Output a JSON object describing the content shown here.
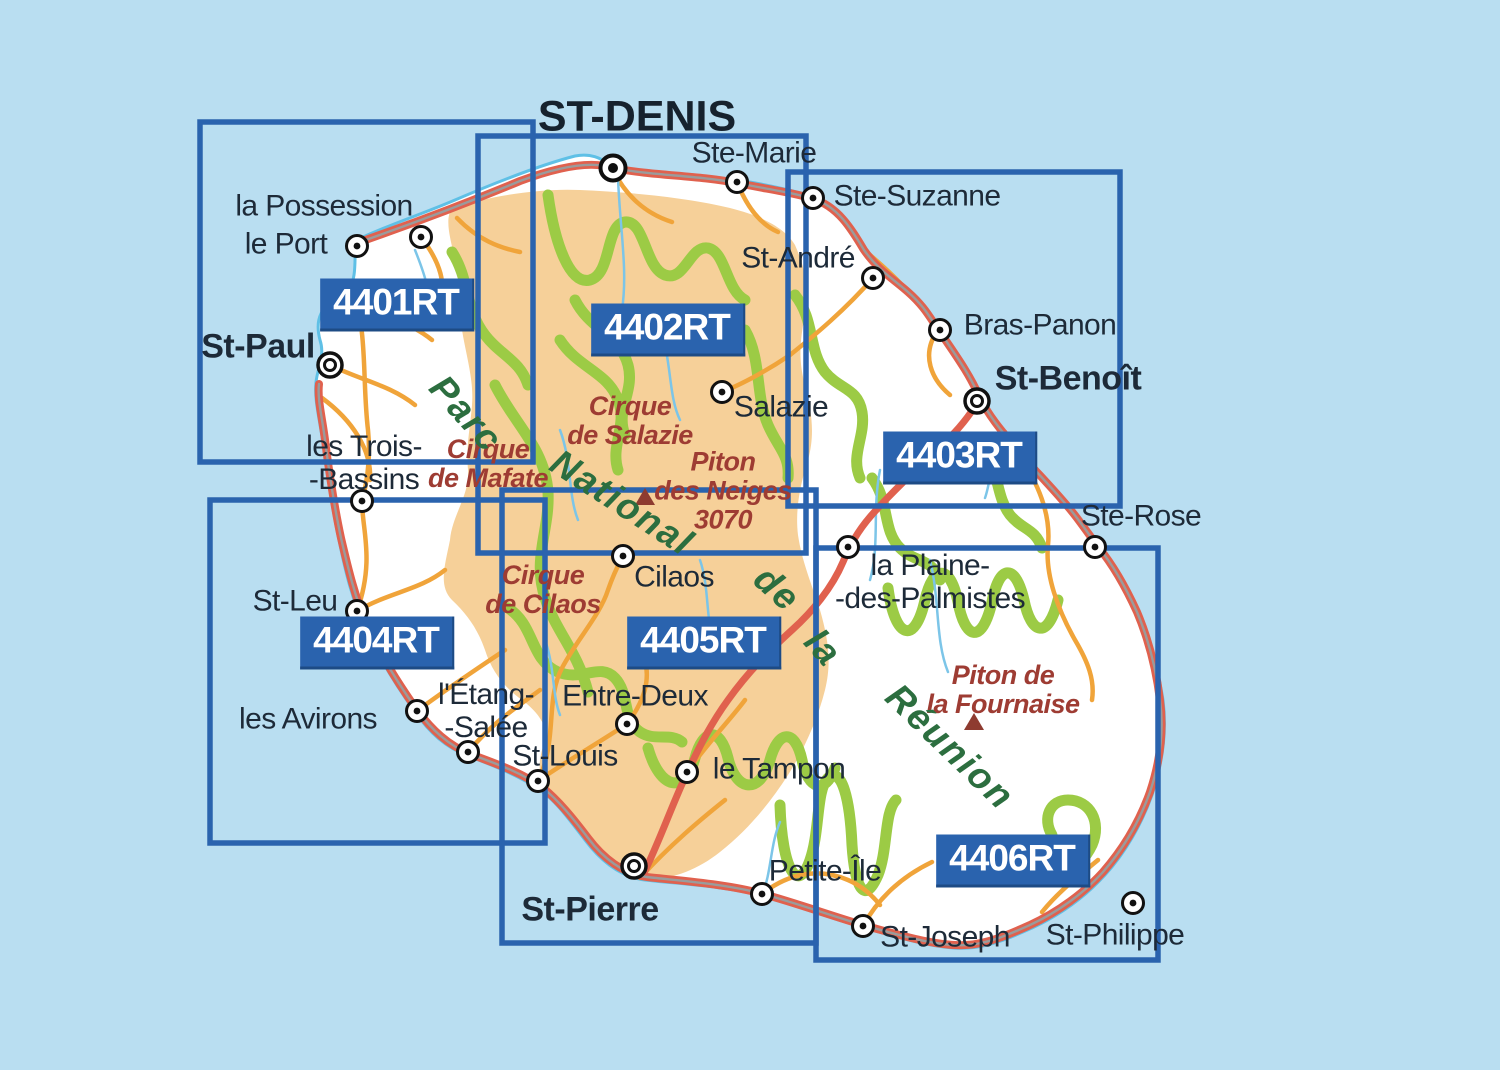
{
  "title": "Carte index des cartes IGN TOP25 R de la Réunion",
  "colors": {
    "sea": "#b9def1",
    "land": "#ffffff",
    "park_tan": "#f6d099",
    "coast": "#5fc0e6",
    "green_road": "#9ccb45",
    "orange_road": "#f0a43a",
    "red_road": "#e0614e",
    "road_core": "#9b9b9b",
    "river": "#7cc5e8",
    "sheet_blue": "#2a63ae",
    "town_text": "#1d2a38",
    "geo_red": "#9e3c33",
    "geo_green": "#2c6e3f",
    "peak": "#8e3b30"
  },
  "sheets": [
    {
      "code": "4401RT",
      "rect": {
        "x": 200,
        "y": 122,
        "w": 333,
        "h": 340
      },
      "label": {
        "cx": 397,
        "cy": 305
      }
    },
    {
      "code": "4402RT",
      "rect": {
        "x": 478,
        "y": 136,
        "w": 328,
        "h": 417
      },
      "label": {
        "cx": 668,
        "cy": 330
      }
    },
    {
      "code": "4403RT",
      "rect": {
        "x": 788,
        "y": 172,
        "w": 332,
        "h": 334
      },
      "label": {
        "cx": 960,
        "cy": 458
      }
    },
    {
      "code": "4404RT",
      "rect": {
        "x": 210,
        "y": 500,
        "w": 335,
        "h": 343
      },
      "label": {
        "cx": 377,
        "cy": 643
      }
    },
    {
      "code": "4405RT",
      "rect": {
        "x": 502,
        "y": 490,
        "w": 314,
        "h": 453
      },
      "label": {
        "cx": 704,
        "cy": 643
      }
    },
    {
      "code": "4406RT",
      "rect": {
        "x": 816,
        "y": 548,
        "w": 342,
        "h": 412
      },
      "label": {
        "cx": 1013,
        "cy": 861
      }
    }
  ],
  "towns": [
    {
      "name": "ST-DENIS",
      "dot": {
        "x": 613,
        "y": 168,
        "type": "capital"
      },
      "label": {
        "x": 637,
        "y": 117,
        "style": "caps"
      }
    },
    {
      "name": "Ste-Marie",
      "dot": {
        "x": 737,
        "y": 182,
        "type": "town"
      },
      "label": {
        "x": 754,
        "y": 153,
        "style": ""
      }
    },
    {
      "name": "Ste-Suzanne",
      "dot": {
        "x": 813,
        "y": 198,
        "type": "town"
      },
      "label": {
        "x": 917,
        "y": 196,
        "style": ""
      }
    },
    {
      "name": "la Possession",
      "dot": {
        "x": 421,
        "y": 237,
        "type": "town"
      },
      "label": {
        "x": 324,
        "y": 206,
        "style": ""
      }
    },
    {
      "name": "le Port",
      "dot": {
        "x": 357,
        "y": 246,
        "type": "town"
      },
      "label": {
        "x": 286,
        "y": 244,
        "style": ""
      }
    },
    {
      "name": "St-André",
      "dot": {
        "x": 873,
        "y": 278,
        "type": "town"
      },
      "label": {
        "x": 798,
        "y": 258,
        "style": ""
      }
    },
    {
      "name": "Bras-Panon",
      "dot": {
        "x": 940,
        "y": 330,
        "type": "town"
      },
      "label": {
        "x": 1040,
        "y": 325,
        "style": ""
      }
    },
    {
      "name": "St-Benoît",
      "dot": {
        "x": 977,
        "y": 401,
        "type": "city"
      },
      "label": {
        "x": 1068,
        "y": 379,
        "style": "bold"
      }
    },
    {
      "name": "St-Paul",
      "dot": {
        "x": 330,
        "y": 365,
        "type": "city"
      },
      "label": {
        "x": 258,
        "y": 347,
        "style": "bold"
      }
    },
    {
      "name": "Salazie",
      "dot": {
        "x": 722,
        "y": 392,
        "type": "town"
      },
      "label": {
        "x": 781,
        "y": 407,
        "style": ""
      }
    },
    {
      "name": "les Trois-\n-Bassins",
      "dot": {
        "x": 362,
        "y": 501,
        "type": "town"
      },
      "label": {
        "x": 364,
        "y": 463,
        "style": ""
      }
    },
    {
      "name": "Ste-Rose",
      "dot": {
        "x": 1095,
        "y": 547,
        "type": "town"
      },
      "label": {
        "x": 1141,
        "y": 516,
        "style": ""
      }
    },
    {
      "name": "Cilaos",
      "dot": {
        "x": 623,
        "y": 556,
        "type": "town"
      },
      "label": {
        "x": 674,
        "y": 577,
        "style": ""
      }
    },
    {
      "name": "la Plaine-\n-des-Palmistes",
      "dot": {
        "x": 848,
        "y": 547,
        "type": "town"
      },
      "label": {
        "x": 930,
        "y": 582,
        "style": ""
      }
    },
    {
      "name": "St-Leu",
      "dot": {
        "x": 357,
        "y": 611,
        "type": "town"
      },
      "label": {
        "x": 295,
        "y": 601,
        "style": ""
      }
    },
    {
      "name": "les Avirons",
      "dot": {
        "x": 417,
        "y": 711,
        "type": "town"
      },
      "label": {
        "x": 308,
        "y": 719,
        "style": ""
      }
    },
    {
      "name": "l'Étang-\n-Salée",
      "dot": {
        "x": 468,
        "y": 752,
        "type": "town"
      },
      "label": {
        "x": 486,
        "y": 711,
        "style": ""
      }
    },
    {
      "name": "Entre-Deux",
      "dot": {
        "x": 627,
        "y": 724,
        "type": "town"
      },
      "label": {
        "x": 635,
        "y": 696,
        "style": ""
      }
    },
    {
      "name": "St-Louis",
      "dot": {
        "x": 538,
        "y": 781,
        "type": "town"
      },
      "label": {
        "x": 565,
        "y": 756,
        "style": ""
      }
    },
    {
      "name": "le Tampon",
      "dot": {
        "x": 687,
        "y": 772,
        "type": "town"
      },
      "label": {
        "x": 779,
        "y": 769,
        "style": ""
      }
    },
    {
      "name": "Petite-Île",
      "dot": {
        "x": 762,
        "y": 894,
        "type": "town"
      },
      "label": {
        "x": 825,
        "y": 871,
        "style": ""
      }
    },
    {
      "name": "St-Pierre",
      "dot": {
        "x": 634,
        "y": 866,
        "type": "city"
      },
      "label": {
        "x": 590,
        "y": 910,
        "style": "bold"
      }
    },
    {
      "name": "St-Joseph",
      "dot": {
        "x": 863,
        "y": 926,
        "type": "town"
      },
      "label": {
        "x": 945,
        "y": 937,
        "style": ""
      }
    },
    {
      "name": "St-Philippe",
      "dot": {
        "x": 1133,
        "y": 903,
        "type": "town"
      },
      "label": {
        "x": 1115,
        "y": 935,
        "style": ""
      }
    }
  ],
  "geo_labels": [
    {
      "text": "Cirque\nde Salazie",
      "cx": 630,
      "cy": 421,
      "cls": "red",
      "rot": 0
    },
    {
      "text": "Cirque\nde Mafate",
      "cx": 488,
      "cy": 464,
      "cls": "red",
      "rot": 0
    },
    {
      "text": "Cirque\nde Cilaos",
      "cx": 543,
      "cy": 590,
      "cls": "red",
      "rot": 0
    },
    {
      "text": "Piton\ndes Neiges\n3070",
      "cx": 723,
      "cy": 491,
      "cls": "red",
      "rot": 0
    },
    {
      "text": "Piton de\nla Fournaise",
      "cx": 1003,
      "cy": 690,
      "cls": "red",
      "rot": 0
    },
    {
      "text": "Parc",
      "cx": 466,
      "cy": 414,
      "cls": "green",
      "rot": 48
    },
    {
      "text": "National",
      "cx": 622,
      "cy": 503,
      "cls": "green",
      "rot": 33
    },
    {
      "text": "de",
      "cx": 777,
      "cy": 589,
      "cls": "green",
      "rot": 42
    },
    {
      "text": "la",
      "cx": 823,
      "cy": 648,
      "cls": "green",
      "rot": 48
    },
    {
      "text": "Réunion",
      "cx": 950,
      "cy": 747,
      "cls": "green",
      "rot": 44
    }
  ],
  "peaks": [
    {
      "name": "Piton des Neiges",
      "x": 645,
      "y": 497
    },
    {
      "name": "Piton de la Fournaise",
      "x": 974,
      "y": 722
    }
  ]
}
